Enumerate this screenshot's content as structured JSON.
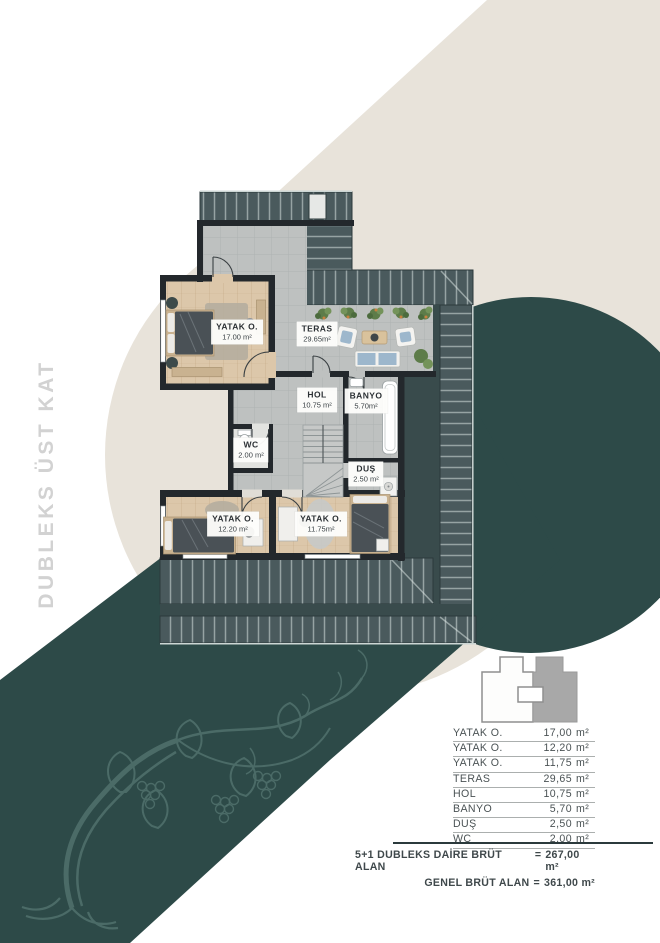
{
  "side_title": {
    "text": "DUBLEKS ÜST KAT"
  },
  "plan": {
    "rooms": [
      {
        "name": "YATAK O.",
        "area": "17.00 m²"
      },
      {
        "name": "TERAS",
        "area": "29.65m²"
      },
      {
        "name": "HOL",
        "area": "10.75 m²"
      },
      {
        "name": "BANYO",
        "area": "5.70m²"
      },
      {
        "name": "WC",
        "area": "2.00 m²"
      },
      {
        "name": "DUŞ",
        "area": "2.50 m²"
      },
      {
        "name": "YATAK O.",
        "area": "12.20 m²"
      },
      {
        "name": "YATAK O.",
        "area": "11.75m²"
      }
    ]
  },
  "table": {
    "rows": [
      {
        "label": "YATAK O.",
        "value": "17,00",
        "unit": "m²"
      },
      {
        "label": "YATAK O.",
        "value": "12,20",
        "unit": "m²"
      },
      {
        "label": "YATAK O.",
        "value": "11,75",
        "unit": "m²"
      },
      {
        "label": "TERAS",
        "value": "29,65",
        "unit": "m²"
      },
      {
        "label": "HOL",
        "value": "10,75",
        "unit": "m²"
      },
      {
        "label": "BANYO",
        "value": "5,70",
        "unit": "m²"
      },
      {
        "label": "DUŞ",
        "value": "2,50",
        "unit": "m²"
      },
      {
        "label": "WC",
        "value": "2,00",
        "unit": "m²"
      }
    ],
    "totals": [
      {
        "label": "5+1 DUBLEKS DAİRE BRÜT ALAN",
        "op": "=",
        "value": "267,00 m²"
      },
      {
        "label": "GENEL BRÜT ALAN",
        "op": "=",
        "value": "361,00 m²"
      }
    ]
  },
  "colors": {
    "beige": "#e8e3da",
    "teal": "#2d4a48",
    "roof": "#4a5a5d",
    "roof_dark": "#394b4c",
    "wall": "#23282c",
    "tile": "#bec1c0",
    "wood": "#dcc7aa",
    "title_gray": "#d2d2d2"
  }
}
